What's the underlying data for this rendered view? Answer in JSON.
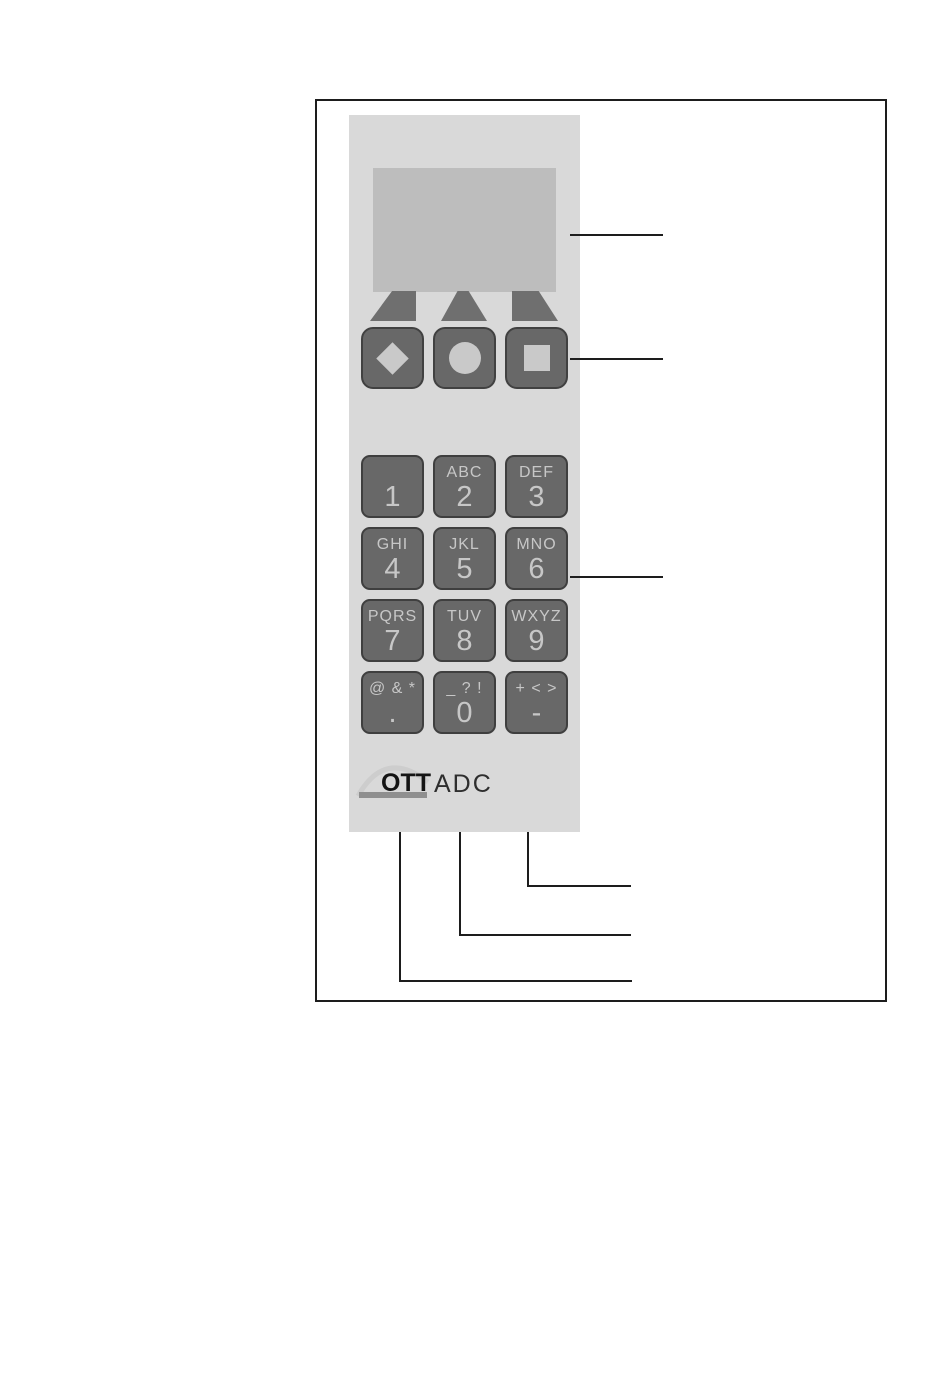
{
  "figure": {
    "description": "Manual figure of OTT ADC handheld device front panel with callout lines",
    "device": {
      "display": {
        "content": ""
      },
      "softkey_arrows": [
        {
          "icon": "pointer-up-left-icon"
        },
        {
          "icon": "pointer-up-icon"
        },
        {
          "icon": "pointer-up-right-icon"
        }
      ],
      "function_keys": [
        {
          "icon": "diamond-icon"
        },
        {
          "icon": "circle-icon"
        },
        {
          "icon": "square-icon"
        }
      ],
      "keypad_keys": [
        {
          "letters": "",
          "digit": "1"
        },
        {
          "letters": "ABC",
          "digit": "2"
        },
        {
          "letters": "DEF",
          "digit": "3"
        },
        {
          "letters": "GHI",
          "digit": "4"
        },
        {
          "letters": "JKL",
          "digit": "5"
        },
        {
          "letters": "MNO",
          "digit": "6"
        },
        {
          "letters": "PQRS",
          "digit": "7"
        },
        {
          "letters": "TUV",
          "digit": "8"
        },
        {
          "letters": "WXYZ",
          "digit": "9"
        },
        {
          "letters": "@ & *",
          "digit": "."
        },
        {
          "letters": "_ ? !",
          "digit": "0"
        },
        {
          "letters": "+ < >",
          "digit": "-"
        }
      ],
      "logo": {
        "brand": "OTT",
        "model": "ADC"
      }
    },
    "colors": {
      "panel": "#d9d9d9",
      "display": "#bdbdbd",
      "key_fill": "#686868",
      "key_border": "#3f3f3f",
      "key_text": "#c7c7c7",
      "arrow_fill": "#6f6f6f",
      "glyph_fill": "#c9c9c9",
      "callout_line": "#1d1d1d",
      "logo_bar": "#8f8f8f",
      "logo_arc": "#cdcdcd"
    }
  }
}
